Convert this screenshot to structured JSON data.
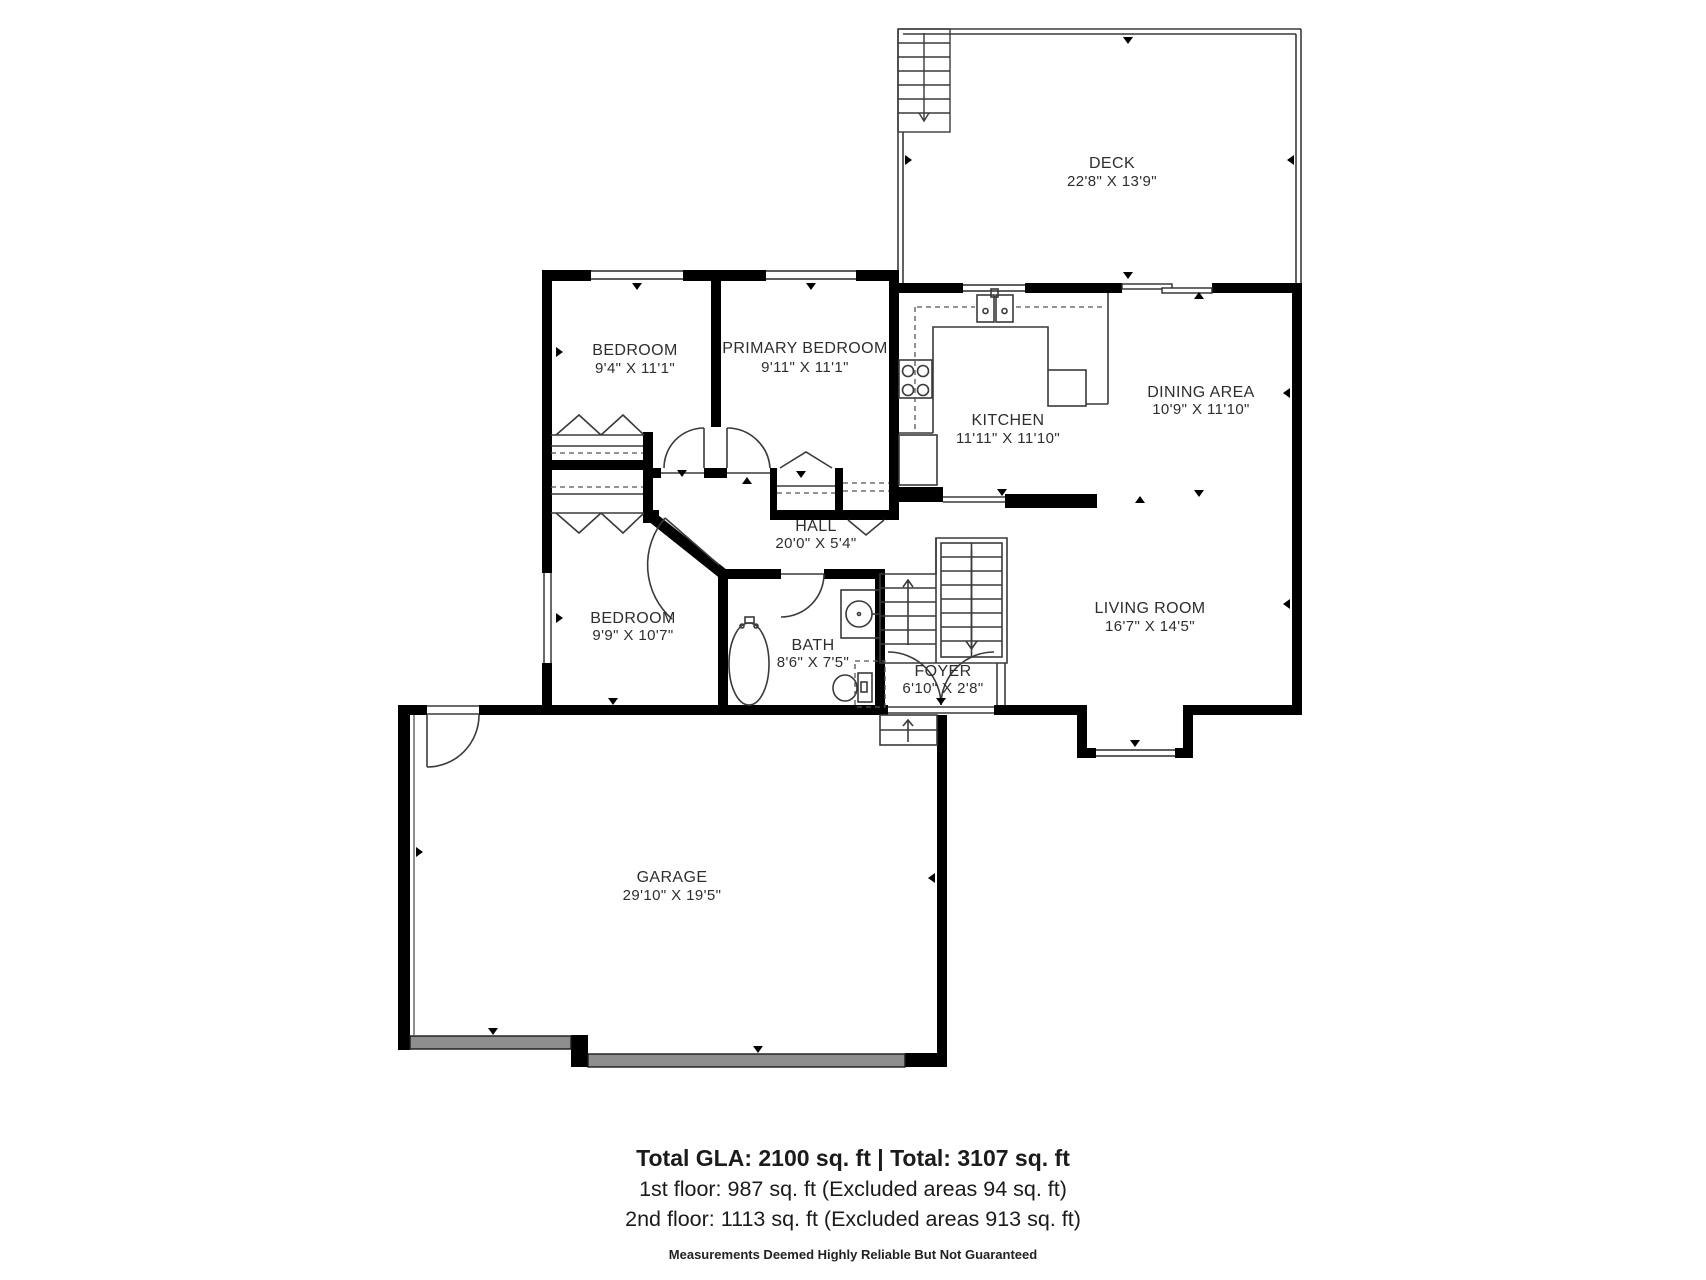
{
  "rooms": {
    "deck": {
      "name": "DECK",
      "dims": "22'8\" X 13'9\""
    },
    "bedroom1": {
      "name": "BEDROOM",
      "dims": "9'4\" X 11'1\""
    },
    "primary": {
      "name": "PRIMARY BEDROOM",
      "dims": "9'11\" X 11'1\""
    },
    "kitchen": {
      "name": "KITCHEN",
      "dims": "11'11\" X 11'10\""
    },
    "dining": {
      "name": "DINING AREA",
      "dims": "10'9\" X 11'10\""
    },
    "hall": {
      "name": "HALL",
      "dims": "20'0\" X 5'4\""
    },
    "bedroom3": {
      "name": "BEDROOM",
      "dims": "9'9\" X 10'7\""
    },
    "bath": {
      "name": "BATH",
      "dims": "8'6\" X 7'5\""
    },
    "foyer": {
      "name": "FOYER",
      "dims": "6'10\" X 2'8\""
    },
    "living": {
      "name": "LIVING ROOM",
      "dims": "16'7\" X 14'5\""
    },
    "garage": {
      "name": "GARAGE",
      "dims": "29'10\" X 19'5\""
    }
  },
  "footer": {
    "line1": "Total GLA: 2100 sq. ft | Total: 3107 sq. ft",
    "line2": "1st floor: 987 sq. ft (Excluded areas 94 sq. ft)",
    "line3": "2nd floor: 1113 sq. ft (Excluded areas 913 sq. ft)",
    "disclaimer": "Measurements Deemed Highly Reliable But Not Guaranteed"
  },
  "colors": {
    "wall": "#000000",
    "thin_line": "#3a3a3a",
    "garage_door": "#8e8e8e",
    "text": "#2e2e2e"
  }
}
